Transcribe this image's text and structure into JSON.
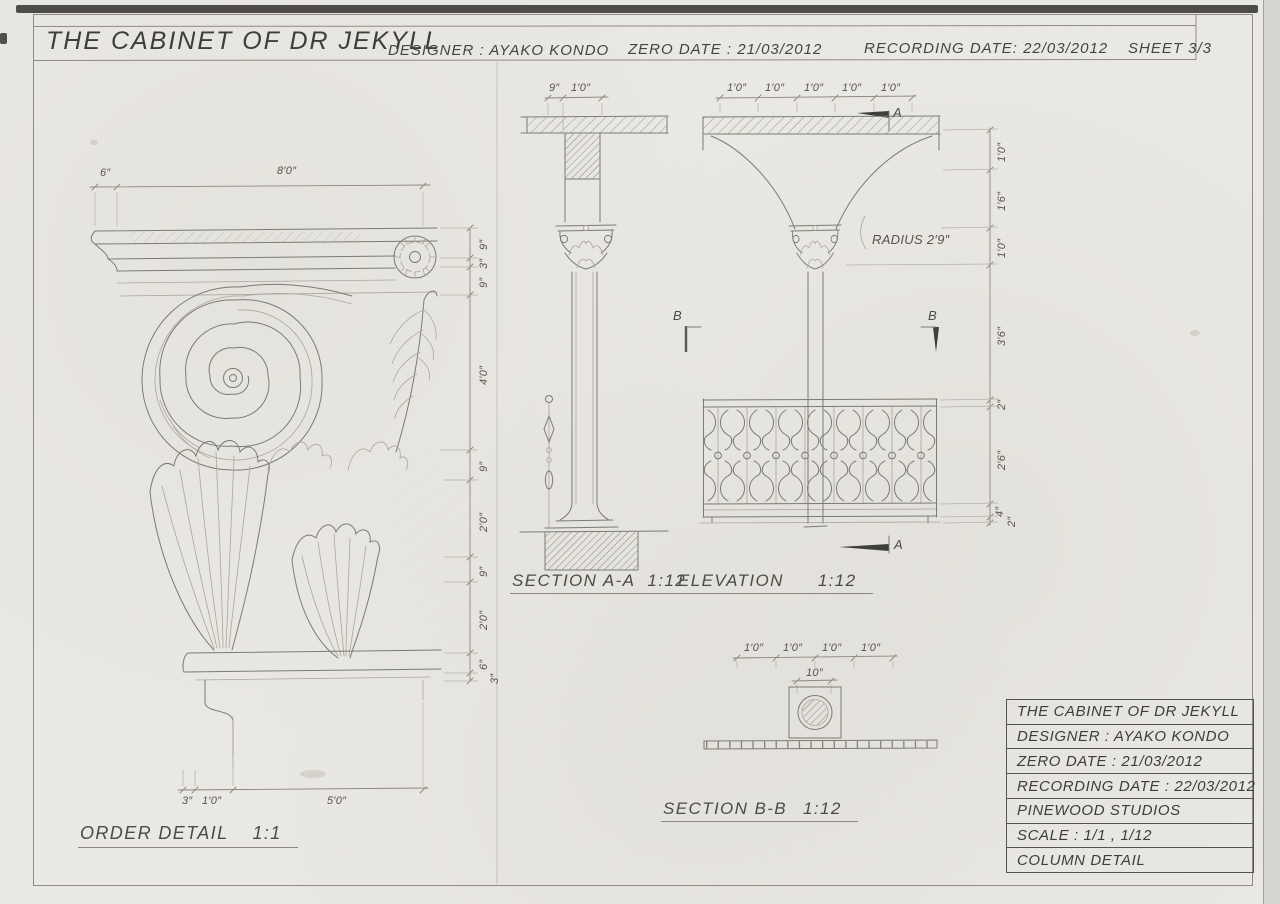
{
  "header": {
    "title": "THE CABINET OF DR JEKYLL",
    "designer": "DESIGNER : AYAKO KONDO",
    "zero_date": "ZERO DATE : 21/03/2012",
    "recording_date": "RECORDING DATE: 22/03/2012",
    "sheet": "SHEET 3/3"
  },
  "drawings": {
    "order_detail": {
      "name": "ORDER DETAIL",
      "scale": "1:1",
      "dims_top": [
        "6″",
        "8′0″"
      ],
      "dims_right": [
        "9″",
        "3″",
        "9″",
        "4′0″",
        "9″",
        "2′0″",
        "9″",
        "2′0″",
        "6″",
        "3″"
      ],
      "dims_bottom": [
        "3″",
        "1′0″",
        "5′0″"
      ]
    },
    "section_aa": {
      "name": "SECTION A-A",
      "scale": "1:12",
      "dims_top": [
        "9″",
        "1′0″"
      ]
    },
    "elevation": {
      "name": "ELEVATION",
      "scale": "1:12",
      "dims_top": [
        "1′0″",
        "1′0″",
        "1′0″",
        "1′0″",
        "1′0″"
      ],
      "dims_right": [
        "1′0″",
        "1′6″",
        "1′0″",
        "3′6″",
        "2″",
        "2′6″",
        "4″",
        "2″"
      ],
      "radius_note": "RADIUS 2′9″",
      "marker_a_top": "A",
      "marker_b_left": "B",
      "marker_b_right": "B",
      "marker_a_bottom": "A"
    },
    "section_bb": {
      "name": "SECTION B-B",
      "scale": "1:12",
      "dims_top": [
        "1′0″",
        "1′0″",
        "1′0″",
        "1′0″"
      ],
      "dim_shaft": "10″"
    }
  },
  "title_block": {
    "rows": [
      "THE CABINET OF DR JEKYLL",
      "DESIGNER : AYAKO KONDO",
      "ZERO DATE : 21/03/2012",
      "RECORDING DATE : 22/03/2012",
      "PINEWOOD STUDIOS",
      "SCALE : 1/1 , 1/12",
      "COLUMN DETAIL"
    ]
  },
  "colors": {
    "paper": "#eae8e2",
    "pencil": "#7b7a73",
    "pencil_light": "#a8a69d",
    "ink_dark": "#3f3e39"
  }
}
